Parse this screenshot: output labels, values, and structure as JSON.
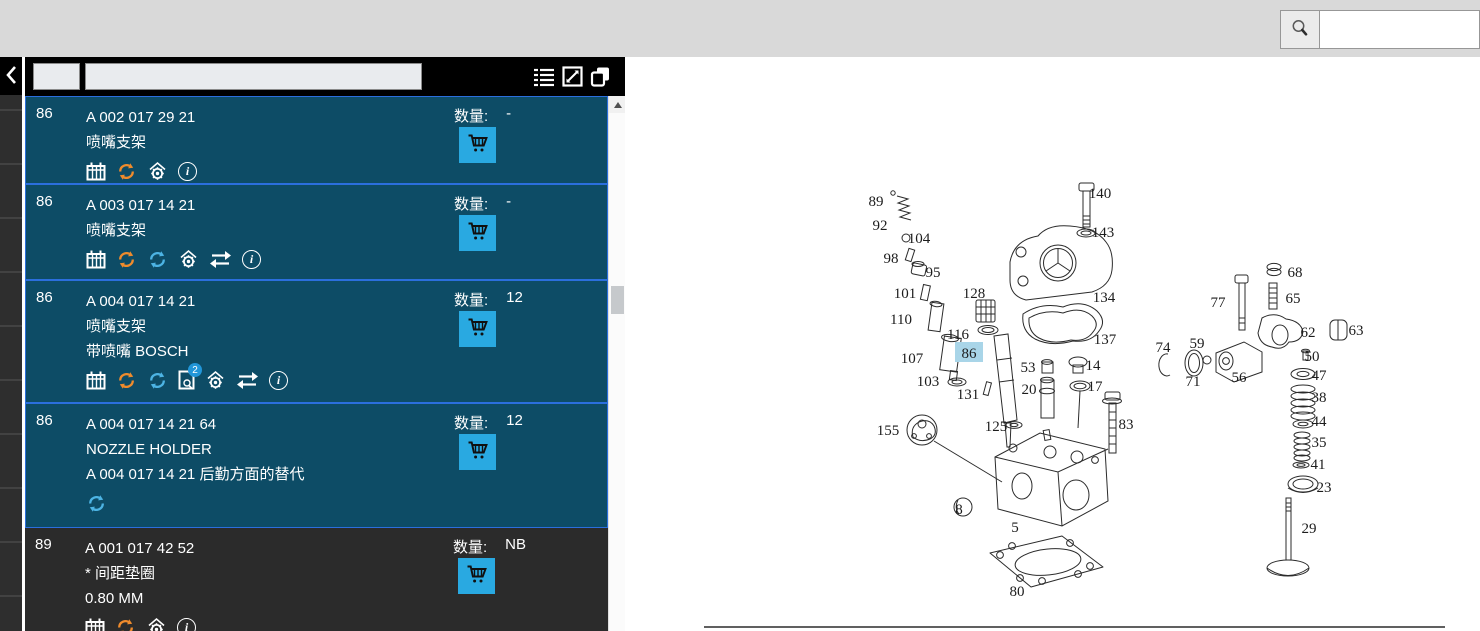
{
  "topbar": {
    "search_icon": "magnifier",
    "search_value": ""
  },
  "toolbar": {
    "edit_icon": "edit-pencil"
  },
  "left_strip": {
    "back_icon": "chevron-left"
  },
  "panel": {
    "header": {
      "code_field_value": "",
      "filter_field_value": "",
      "icons": [
        "list",
        "fullscreen",
        "copy"
      ]
    },
    "qty_label": "数量:",
    "rows": [
      {
        "pos": "86",
        "part_number": "A 002 017 29 21",
        "name_lines": [
          "喷嘴支架"
        ],
        "qty": "-",
        "icons": [
          "calendar",
          "refresh-orange",
          "factory-gear",
          "info"
        ],
        "selected": true
      },
      {
        "pos": "86",
        "part_number": "A 003 017 14 21",
        "name_lines": [
          "喷嘴支架"
        ],
        "qty": "-",
        "icons": [
          "calendar",
          "refresh-orange",
          "refresh-blue",
          "factory-gear",
          "swap",
          "info"
        ],
        "selected": true
      },
      {
        "pos": "86",
        "part_number": "A 004 017 14 21",
        "name_lines": [
          "喷嘴支架",
          "带喷嘴 BOSCH"
        ],
        "qty": "12",
        "icons": [
          "calendar",
          "refresh-orange",
          "refresh-blue",
          "doc-badge-2",
          "factory-gear",
          "swap",
          "info"
        ],
        "doc_badge_count": "2",
        "selected": true
      },
      {
        "pos": "86",
        "part_number": "A 004 017 14 21 64",
        "name_lines": [
          "NOZZLE HOLDER",
          "A 004 017 14 21 后勤方面的替代"
        ],
        "qty": "12",
        "icons": [
          "refresh-blue"
        ],
        "selected": true
      },
      {
        "pos": "89",
        "part_number": "A 001 017 42 52",
        "name_lines": [
          "* 间距垫圈",
          "0.80 MM"
        ],
        "qty": "NB",
        "icons": [
          "calendar",
          "refresh-orange",
          "factory-gear",
          "info"
        ],
        "selected": false
      }
    ]
  },
  "diagram": {
    "highlighted_label": "86",
    "highlight_color": "#a9d5e8",
    "labels": [
      {
        "t": "89",
        "x": 876,
        "y": 201
      },
      {
        "t": "92",
        "x": 880,
        "y": 225
      },
      {
        "t": "104",
        "x": 919,
        "y": 238
      },
      {
        "t": "98",
        "x": 891,
        "y": 258
      },
      {
        "t": "95",
        "x": 933,
        "y": 272
      },
      {
        "t": "101",
        "x": 905,
        "y": 293
      },
      {
        "t": "110",
        "x": 901,
        "y": 319
      },
      {
        "t": "128",
        "x": 974,
        "y": 293
      },
      {
        "t": "116",
        "x": 958,
        "y": 334
      },
      {
        "t": "86",
        "x": 969,
        "y": 353,
        "hl": true
      },
      {
        "t": "107",
        "x": 912,
        "y": 358
      },
      {
        "t": "103",
        "x": 928,
        "y": 381
      },
      {
        "t": "131",
        "x": 968,
        "y": 394
      },
      {
        "t": "53",
        "x": 1028,
        "y": 367
      },
      {
        "t": "20",
        "x": 1029,
        "y": 389
      },
      {
        "t": "14",
        "x": 1093,
        "y": 365
      },
      {
        "t": "17",
        "x": 1095,
        "y": 386
      },
      {
        "t": "140",
        "x": 1100,
        "y": 193
      },
      {
        "t": "143",
        "x": 1103,
        "y": 232
      },
      {
        "t": "134",
        "x": 1104,
        "y": 297
      },
      {
        "t": "137",
        "x": 1105,
        "y": 339
      },
      {
        "t": "155",
        "x": 888,
        "y": 430
      },
      {
        "t": "125",
        "x": 996,
        "y": 426
      },
      {
        "t": "83",
        "x": 1126,
        "y": 424
      },
      {
        "t": "8",
        "x": 959,
        "y": 509
      },
      {
        "t": "5",
        "x": 1015,
        "y": 527
      },
      {
        "t": "80",
        "x": 1017,
        "y": 591
      },
      {
        "t": "68",
        "x": 1295,
        "y": 272
      },
      {
        "t": "65",
        "x": 1293,
        "y": 298
      },
      {
        "t": "77",
        "x": 1218,
        "y": 302
      },
      {
        "t": "62",
        "x": 1308,
        "y": 332
      },
      {
        "t": "63",
        "x": 1356,
        "y": 330
      },
      {
        "t": "74",
        "x": 1163,
        "y": 347
      },
      {
        "t": "59",
        "x": 1197,
        "y": 343
      },
      {
        "t": "71",
        "x": 1193,
        "y": 381
      },
      {
        "t": "56",
        "x": 1239,
        "y": 377
      },
      {
        "t": "50",
        "x": 1312,
        "y": 356
      },
      {
        "t": "47",
        "x": 1319,
        "y": 375
      },
      {
        "t": "38",
        "x": 1319,
        "y": 397
      },
      {
        "t": "44",
        "x": 1319,
        "y": 421
      },
      {
        "t": "35",
        "x": 1319,
        "y": 442
      },
      {
        "t": "41",
        "x": 1318,
        "y": 464
      },
      {
        "t": "23",
        "x": 1324,
        "y": 487
      },
      {
        "t": "29",
        "x": 1309,
        "y": 528
      }
    ]
  },
  "colors": {
    "topbar_bg": "#d9d9d9",
    "selected_row_bg": "#0d4c66",
    "selected_row_border": "#2b6fdd",
    "dark_row_bg": "#2b2b2b",
    "cart_button": "#29a9e1",
    "refresh_orange": "#ef8b2c",
    "refresh_blue": "#4db4e4",
    "label_highlight": "#a9d5e8"
  }
}
